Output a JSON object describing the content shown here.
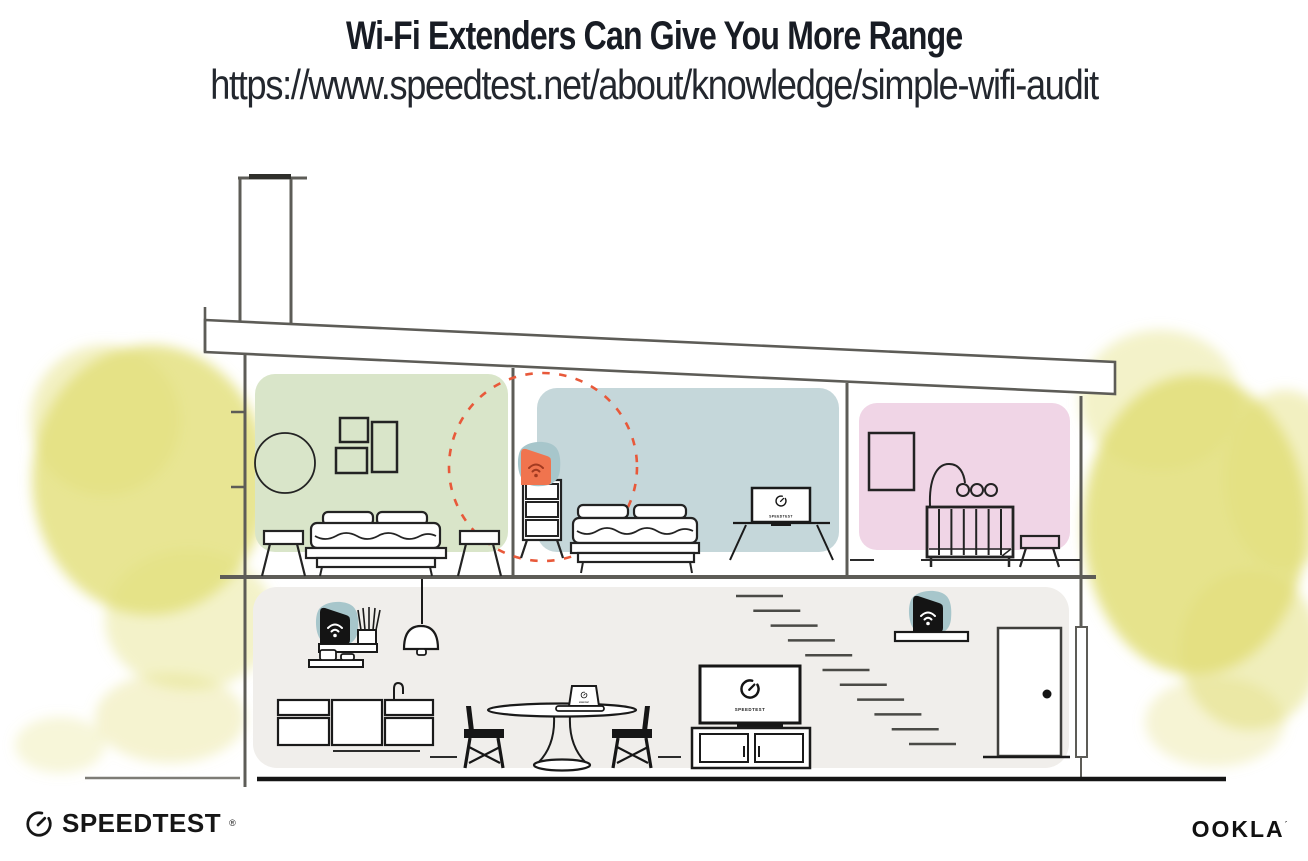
{
  "header": {
    "title": "Wi-Fi Extenders Can Give You More Range",
    "url": "https://www.speedtest.net/about/knowledge/simple-wifi-audit"
  },
  "footer": {
    "speedtest_logo_text": "SPEEDTEST",
    "speedtest_reg_mark": "®",
    "ookla_logo_text": "OOKLA",
    "ookla_tm_mark": "´"
  },
  "illustration": {
    "screens": {
      "tv_label": "SPEEDTEST"
    },
    "colors": {
      "room_green": "#d9e5c9",
      "room_blue": "#c5d7da",
      "room_pink": "#f0d5e6",
      "lower_floor": "#f0eeeb",
      "device_teal": "#a7c6cb",
      "extender_orange": "#f0744e",
      "wifi_maroon": "#a23a20",
      "range_dashed_red": "#e8593a",
      "foliage_yellow": "#e2de78",
      "wall_gray": "#5d5c57",
      "ink": "#1a1a1a"
    }
  }
}
